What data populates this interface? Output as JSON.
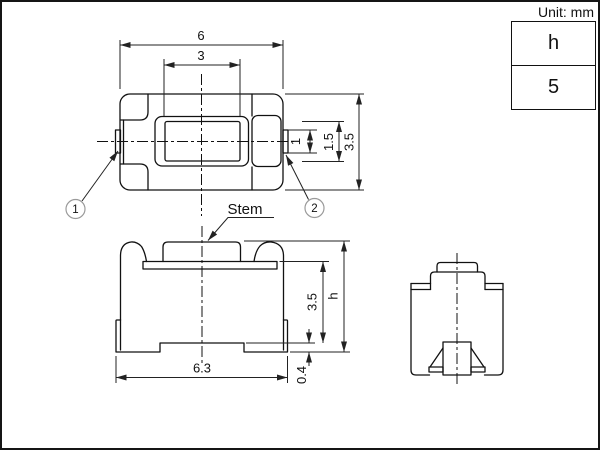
{
  "unit_label": "Unit: mm",
  "table": {
    "rows": [
      "h",
      "5"
    ]
  },
  "dims": {
    "top_width": "6",
    "stem_width": "3",
    "terminal_width": "1",
    "contact_width": "1.5",
    "body_depth": "3.5",
    "front_width": "6.3",
    "front_body_height": "3.5",
    "terminal_thickness": "0.4",
    "total_height": "h"
  },
  "labels": {
    "stem": "Stem",
    "callout_1": "1",
    "callout_2": "2"
  },
  "colors": {
    "line": "#111111",
    "dim": "#222222",
    "callout_stroke": "#9a9a9a",
    "background": "#ffffff"
  }
}
